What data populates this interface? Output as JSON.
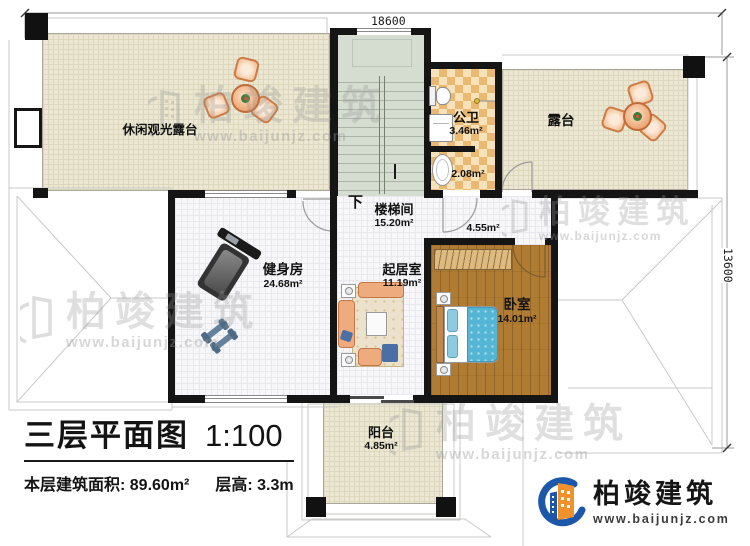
{
  "dimensions": {
    "top": "18600",
    "right": "13600"
  },
  "stair": {
    "down_label": "下"
  },
  "rooms": {
    "leisure_terrace": {
      "name": "休闲观光露台"
    },
    "terrace": {
      "name": "露台"
    },
    "public_bath": {
      "name": "公卫",
      "area": "3.46m²"
    },
    "bath_lobby": {
      "area": "2.08m²"
    },
    "stairwell": {
      "name": "楼梯间",
      "area": "15.20m²"
    },
    "hall": {
      "area": "4.55m²"
    },
    "gym": {
      "name": "健身房",
      "area": "24.68m²"
    },
    "living_room": {
      "name": "起居室",
      "area": "11.19m²"
    },
    "bedroom": {
      "name": "卧室",
      "area": "14.01m²"
    },
    "balcony": {
      "name": "阳台",
      "area": "4.85m²"
    }
  },
  "title_block": {
    "title": "三层平面图",
    "scale": "1:100",
    "floor_area": "本层建筑面积: 89.60m²",
    "floor_height": "层高: 3.3m"
  },
  "brand": {
    "name": "柏竣建筑",
    "url": "www.baijunjz.com"
  },
  "watermark": {
    "name": "柏竣建筑",
    "url": "www.baijunjz.com"
  },
  "colors": {
    "wall": "#151515",
    "terrace_floor": "#ebe7d2",
    "tile_dark": "#e9b873",
    "tile_light": "#f7e2ba",
    "stair_floor": "#d5ddd1",
    "wood_floor": "#b07c34",
    "bed_blue": "#55b5d5",
    "sofa_peach": "#eeab7e",
    "brand_blue": "#1d57a9",
    "brand_orange": "#f0912d"
  }
}
